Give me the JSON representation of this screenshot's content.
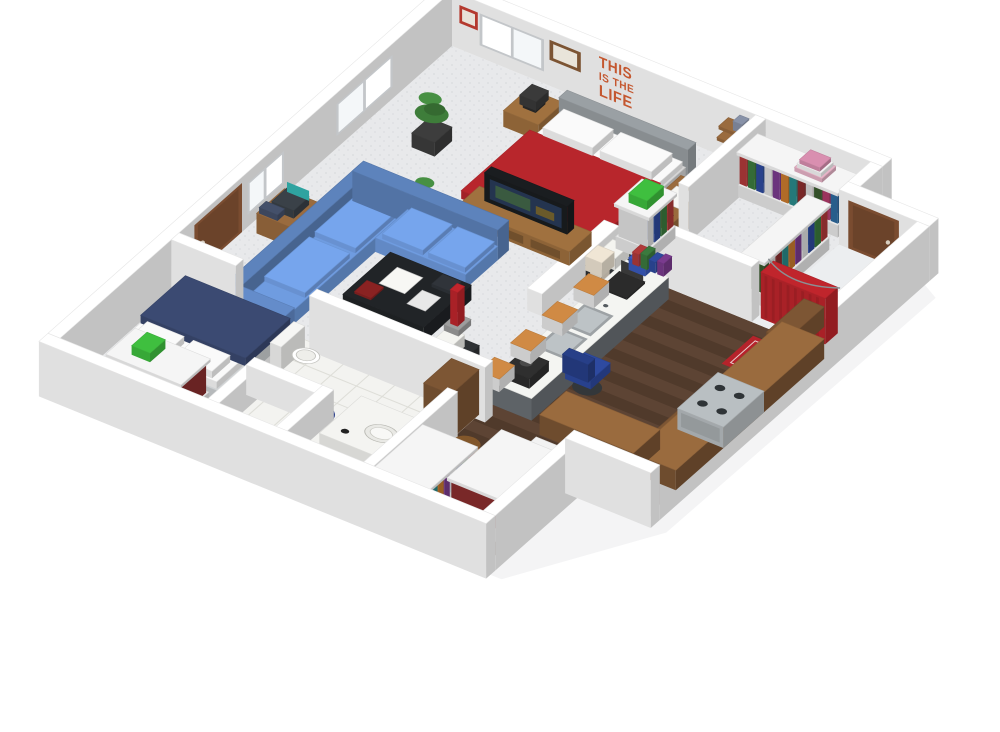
{
  "image": {
    "kind": "isometric-3d-floor-plan-render",
    "background": "#ffffff"
  },
  "wall_decal": {
    "lines": [
      "THIS",
      "IS THE",
      "LIFE"
    ],
    "color": "#c4572f"
  },
  "rooms": [
    "open-living-area",
    "master-sleeping-area",
    "walk-in-closet",
    "kitchen",
    "bathroom",
    "bedroom",
    "closet-room",
    "shower-nook"
  ],
  "palette": {
    "wall": "#ffffff",
    "wall_edge": "#c9ccd0",
    "carpet": "#e8e9eb",
    "carpet_dot": "#d9dadd",
    "wood": "#503a2b",
    "wood_light": "#5d4434",
    "wood_dark": "#433023",
    "tile": "#f3f3f0",
    "tile_line": "#dedeD8",
    "shower_floor": "#eceef0",
    "bed_red": "#b8262c",
    "bed_navy": "#3b4a72",
    "sofa_blue": "#6f9ce0",
    "headboard_gray": "#9aa0a4",
    "wood_furniture": "#a0713f",
    "desk_wood": "#9a6b3e",
    "counter_white": "#f4f5f2",
    "cabinet_brown": "#7d5634",
    "steel": "#b9bfc2",
    "dark": "#1a1d20",
    "tv_screen": "#24344f",
    "curtain_red": "#c0252c",
    "rug_red": "#b5232b",
    "rug_blue": "#2b3f8c",
    "stool_orange": "#d08a44",
    "plant_green": "#3e7d3a",
    "door_brown": "#7a4c30",
    "lamp_cream": "#e9dfcf",
    "bag_blue": "#3a5bbf",
    "chair_navy": "#2e4aa0",
    "laptop_teal": "#2fa3a0",
    "basket_wicker": "#b5793c",
    "green_accent": "#3fbf3f",
    "mattress_white": "#fafafa",
    "clothes": [
      "#b03a3a",
      "#3b7a3e",
      "#2e4a9e",
      "#e0e0e0",
      "#7a3b8e",
      "#c87a2e",
      "#2a8a8a",
      "#8a2e2e",
      "#d8d8d8",
      "#3a5a2e",
      "#b03a6a",
      "#2e6a9e"
    ]
  }
}
